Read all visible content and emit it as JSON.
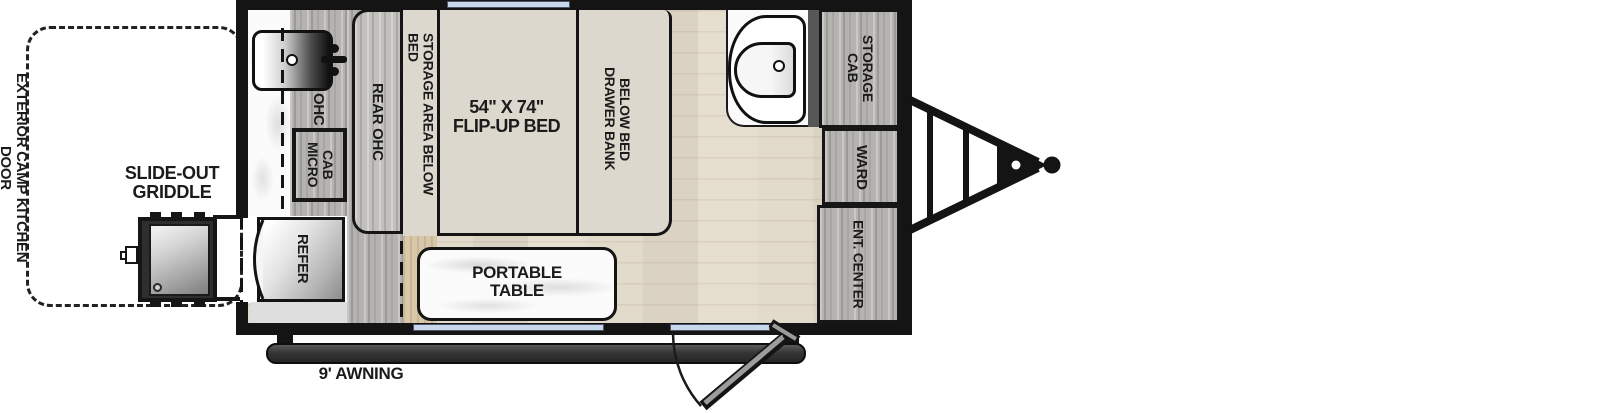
{
  "diagram": {
    "type": "travel trailer floorplan, overhead view",
    "features": [
      "exterior camp kitchen",
      "slide-out griddle",
      "flip-up bed",
      "portable table",
      "awning",
      "entry door",
      "tongue hitch"
    ]
  },
  "exterior_kitchen": {
    "door_label": "EXTERIOR CAMP KITCHEN DOOR",
    "griddle_label": "SLIDE-OUT\nGRIDDLE"
  },
  "kitchen": {
    "overhead_cabinet": "OHC",
    "microwave_cabinet": "MICRO\nCAB",
    "refrigerator": "REFER"
  },
  "bed_area": {
    "rear_overhead_cabinet": "REAR OHC",
    "under_bed_storage": "STORAGE AREA BELOW BED",
    "bed": "54\" X 74\"\nFLIP-UP BED",
    "drawer_bank": "DRAWER BANK\nBELOW BED",
    "portable_table": "PORTABLE\nTABLE"
  },
  "right_wall": {
    "storage_cabinet": "STORAGE\nCAB",
    "wardrobe": "WARD",
    "entertainment_center": "ENT. CENTER"
  },
  "awning": {
    "label": "9' AWNING"
  },
  "colors": {
    "wall": "#141414",
    "window_blue": "#c9d7ec",
    "cabinet_wood": "#b5b3b0",
    "floor_wood": "#e8e1d3",
    "bed_surface": "#ddd8ce",
    "awning_dark": "#333333",
    "bath_divider_gray": "#575757"
  }
}
